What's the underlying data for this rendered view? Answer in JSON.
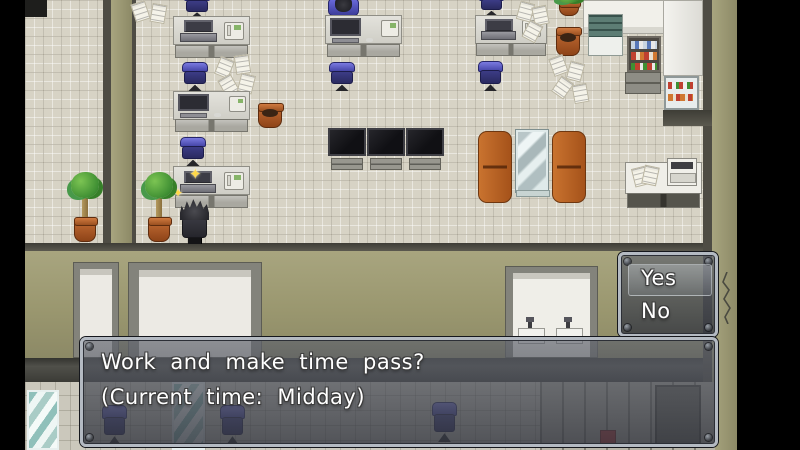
{
  "game": {
    "dialog": {
      "line1": "Work and make time pass?",
      "line2": "(Current time: Midday)"
    },
    "choices": {
      "yes_label": "Yes",
      "no_label": "No",
      "selected": "Yes"
    },
    "decor": {
      "sparkle_glyph": "✦"
    },
    "colors": {
      "floor_tile": "#d7d3c5",
      "wall_olive": "#9a976f",
      "chair_blue": "#4646a8",
      "couch_orange": "#b35b1f",
      "window_frame": "#b4bac2",
      "window_fill": "rgba(52,55,64,0.8)",
      "letterbox": "#000000"
    }
  }
}
